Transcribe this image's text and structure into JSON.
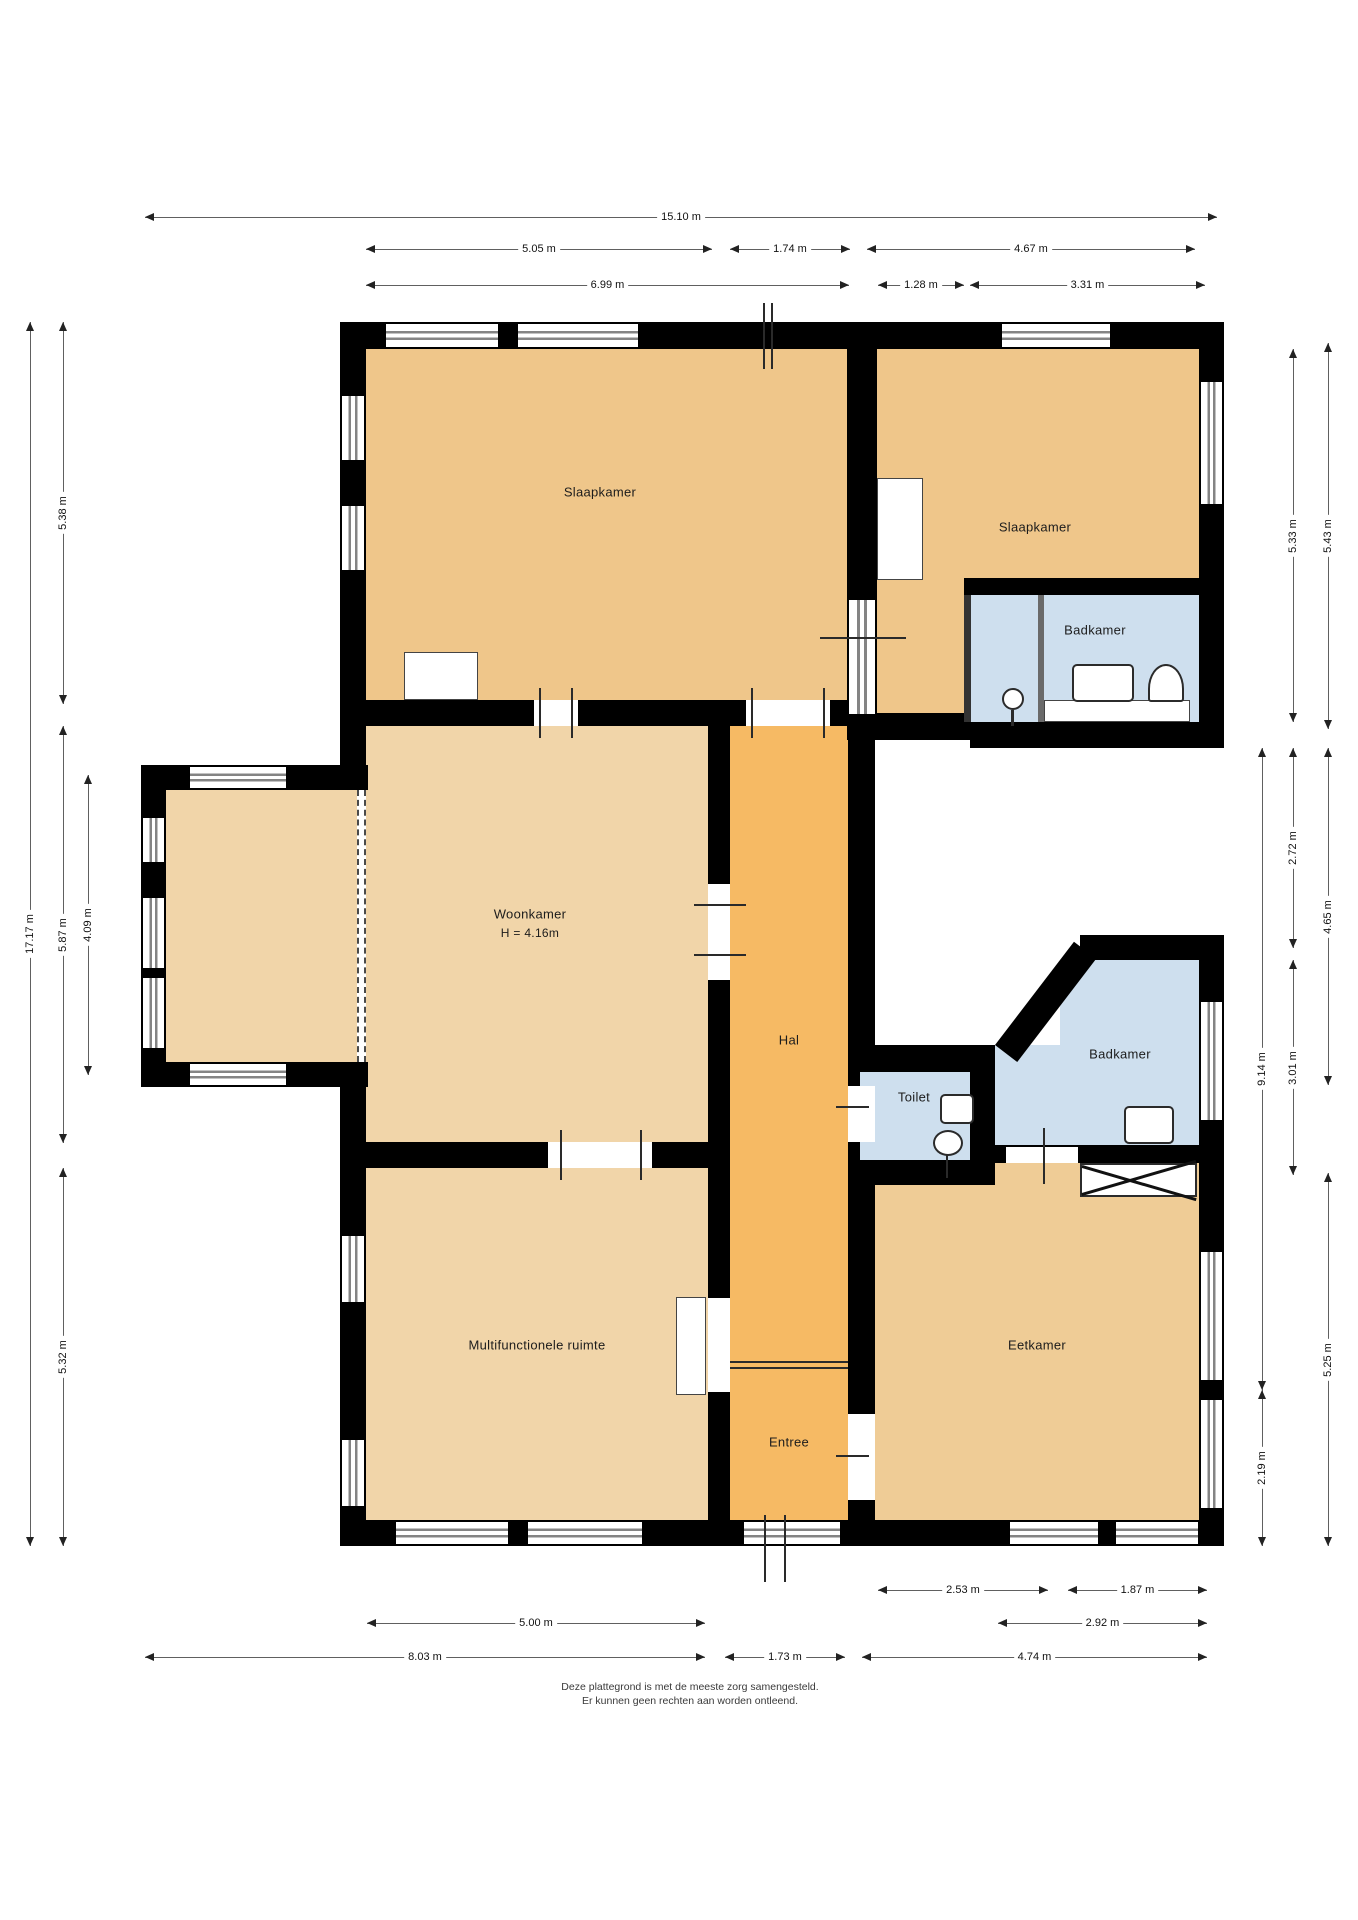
{
  "canvas": {
    "width": 1358,
    "height": 1920,
    "background": "#ffffff"
  },
  "colors": {
    "wall": "#000000",
    "bedroom_tan": "#efc68a",
    "dining_tan": "#efcc96",
    "living_tan": "#f1d5a9",
    "hall_orange": "#f6ba64",
    "bath_blue": "#cedfee",
    "dim_line": "#606060",
    "window_gray": "#848484"
  },
  "floors": [
    {
      "name": "room-slaapkamer-left",
      "x": 366,
      "y": 349,
      "w": 481,
      "h": 351,
      "c": "#efc68a"
    },
    {
      "name": "room-slaapkamer-right-main",
      "x": 877,
      "y": 349,
      "w": 322,
      "h": 229,
      "c": "#efc68a"
    },
    {
      "name": "room-slaapkamer-right-arm",
      "x": 877,
      "y": 578,
      "w": 87,
      "h": 135,
      "c": "#efc68a"
    },
    {
      "name": "room-badkamer-top",
      "x": 970,
      "y": 595,
      "w": 229,
      "h": 127,
      "c": "#cedfee"
    },
    {
      "name": "room-woonkamer",
      "x": 366,
      "y": 726,
      "w": 342,
      "h": 416,
      "c": "#f1d5a9"
    },
    {
      "name": "room-erker-bay",
      "x": 166,
      "y": 790,
      "w": 191,
      "h": 272,
      "c": "#f1d5a9"
    },
    {
      "name": "room-hal-entree",
      "x": 730,
      "y": 726,
      "w": 118,
      "h": 794,
      "c": "#f6ba64"
    },
    {
      "name": "room-toilet",
      "x": 860,
      "y": 1072,
      "w": 110,
      "h": 88,
      "c": "#cedfee"
    },
    {
      "name": "room-badkamer-mid-upper",
      "x": 1060,
      "y": 960,
      "w": 139,
      "h": 85,
      "c": "#cedfee"
    },
    {
      "name": "room-badkamer-mid-lower",
      "x": 995,
      "y": 1045,
      "w": 204,
      "h": 100,
      "c": "#cedfee"
    },
    {
      "name": "room-multifunctionele",
      "x": 366,
      "y": 1168,
      "w": 342,
      "h": 352,
      "c": "#f1d5a9"
    },
    {
      "name": "room-eetkamer",
      "x": 875,
      "y": 1160,
      "w": 324,
      "h": 360,
      "c": "#efcc96"
    }
  ],
  "walls": [
    [
      340,
      322,
      884,
      27
    ],
    [
      340,
      322,
      26,
      443
    ],
    [
      340,
      1087,
      26,
      459
    ],
    [
      340,
      1520,
      884,
      26
    ],
    [
      1199,
      322,
      25,
      426
    ],
    [
      1199,
      935,
      25,
      611
    ],
    [
      340,
      700,
      537,
      26
    ],
    [
      847,
      322,
      30,
      390
    ],
    [
      847,
      713,
      123,
      27
    ],
    [
      970,
      722,
      254,
      26
    ],
    [
      964,
      578,
      235,
      17
    ],
    [
      708,
      726,
      22,
      794
    ],
    [
      848,
      740,
      27,
      332
    ],
    [
      848,
      1072,
      12,
      88
    ],
    [
      848,
      1160,
      27,
      360
    ],
    [
      848,
      1045,
      147,
      27
    ],
    [
      970,
      1045,
      25,
      140
    ],
    [
      848,
      1160,
      147,
      25
    ],
    [
      1080,
      935,
      119,
      25
    ],
    [
      995,
      1145,
      204,
      18
    ],
    [
      340,
      1142,
      390,
      26
    ],
    [
      141,
      765,
      227,
      25
    ],
    [
      141,
      765,
      25,
      322
    ],
    [
      141,
      1062,
      227,
      25
    ]
  ],
  "diag_wall": {
    "x": 995,
    "y": 1045,
    "len": 130,
    "angle": -52.6,
    "th": 28
  },
  "thin_walls": [
    {
      "x": 964,
      "y": 595,
      "w": 7,
      "h": 127,
      "c": "#333333"
    },
    {
      "x": 1038,
      "y": 595,
      "w": 6,
      "h": 127,
      "c": "#6a6a6a"
    }
  ],
  "windows_h": [
    [
      384,
      324,
      112,
      23
    ],
    [
      516,
      324,
      120,
      23
    ],
    [
      1000,
      324,
      108,
      23
    ],
    [
      394,
      1522,
      112,
      22
    ],
    [
      526,
      1522,
      114,
      22
    ],
    [
      742,
      1522,
      96,
      22
    ],
    [
      1008,
      1522,
      88,
      22
    ],
    [
      1114,
      1522,
      82,
      22
    ],
    [
      188,
      767,
      96,
      21
    ],
    [
      188,
      1064,
      96,
      21
    ]
  ],
  "windows_v": [
    [
      342,
      394,
      22,
      64
    ],
    [
      342,
      504,
      22,
      64
    ],
    [
      342,
      1234,
      22,
      66
    ],
    [
      342,
      1438,
      22,
      66
    ],
    [
      1201,
      380,
      21,
      122
    ],
    [
      1201,
      1000,
      21,
      118
    ],
    [
      1201,
      1250,
      21,
      128
    ],
    [
      1201,
      1398,
      21,
      108
    ],
    [
      143,
      816,
      21,
      44
    ],
    [
      143,
      896,
      21,
      70
    ],
    [
      143,
      976,
      21,
      70
    ],
    [
      849,
      598,
      26,
      114
    ]
  ],
  "door_gaps": [
    [
      534,
      700,
      44,
      26
    ],
    [
      746,
      700,
      84,
      26
    ],
    [
      708,
      884,
      22,
      96
    ],
    [
      848,
      1086,
      27,
      56
    ],
    [
      1006,
      1147,
      72,
      16
    ],
    [
      848,
      1414,
      27,
      86
    ],
    [
      708,
      1298,
      22,
      94
    ],
    [
      548,
      1142,
      104,
      26
    ]
  ],
  "ticks": [
    [
      539,
      688,
      2,
      50
    ],
    [
      571,
      688,
      2,
      50
    ],
    [
      751,
      688,
      2,
      50
    ],
    [
      823,
      688,
      2,
      50
    ],
    [
      820,
      637,
      86,
      2
    ],
    [
      694,
      904,
      52,
      2
    ],
    [
      694,
      954,
      52,
      2
    ],
    [
      836,
      1106,
      33,
      2
    ],
    [
      1043,
      1128,
      2,
      56
    ],
    [
      836,
      1455,
      33,
      2
    ],
    [
      560,
      1130,
      2,
      50
    ],
    [
      640,
      1130,
      2,
      50
    ],
    [
      763,
      303,
      2,
      66
    ],
    [
      771,
      303,
      2,
      66
    ],
    [
      764,
      1515,
      2,
      67
    ],
    [
      784,
      1515,
      2,
      67
    ],
    [
      730,
      1361,
      118,
      2
    ],
    [
      730,
      1367,
      118,
      2
    ],
    [
      946,
      1154,
      2,
      24
    ],
    [
      1011,
      710,
      3,
      16
    ]
  ],
  "dashes": [
    [
      357,
      790,
      272
    ],
    [
      364,
      790,
      272
    ]
  ],
  "fixtures": [
    {
      "kind": "box",
      "name": "closet",
      "x": 404,
      "y": 652,
      "w": 74,
      "h": 48
    },
    {
      "kind": "box",
      "name": "door-leaf",
      "x": 877,
      "y": 478,
      "w": 46,
      "h": 102
    },
    {
      "kind": "box",
      "name": "door-leaf",
      "x": 676,
      "y": 1297,
      "w": 30,
      "h": 98
    },
    {
      "kind": "box",
      "name": "bath-counter",
      "x": 1044,
      "y": 700,
      "w": 146,
      "h": 22
    },
    {
      "kind": "rbox",
      "name": "washbasin",
      "x": 1072,
      "y": 664,
      "w": 62,
      "h": 38
    },
    {
      "kind": "arch",
      "name": "shower-sink",
      "x": 1148,
      "y": 664,
      "w": 36,
      "h": 38
    },
    {
      "kind": "circle",
      "name": "toilet-bowl",
      "x": 1002,
      "y": 688,
      "w": 22,
      "h": 22
    },
    {
      "kind": "rbox",
      "name": "hand-basin",
      "x": 940,
      "y": 1094,
      "w": 34,
      "h": 30
    },
    {
      "kind": "ellipse",
      "name": "toilet-bowl",
      "x": 933,
      "y": 1130,
      "w": 30,
      "h": 26
    },
    {
      "kind": "rbox",
      "name": "washbasin",
      "x": 1124,
      "y": 1106,
      "w": 50,
      "h": 38
    },
    {
      "kind": "xbox",
      "name": "cabinet-crossed",
      "x": 1080,
      "y": 1163,
      "w": 117,
      "h": 34
    }
  ],
  "labels": [
    {
      "text": "Slaapkamer",
      "x": 600,
      "y": 492,
      "fs": 13
    },
    {
      "text": "Slaapkamer",
      "x": 1035,
      "y": 527,
      "fs": 13
    },
    {
      "text": "Badkamer",
      "x": 1095,
      "y": 630,
      "fs": 13
    },
    {
      "text": "Woonkamer",
      "x": 530,
      "y": 914,
      "fs": 13
    },
    {
      "text": "H = 4.16m",
      "x": 530,
      "y": 933,
      "fs": 12
    },
    {
      "text": "Hal",
      "x": 789,
      "y": 1040,
      "fs": 13
    },
    {
      "text": "Toilet",
      "x": 914,
      "y": 1097,
      "fs": 13
    },
    {
      "text": "Badkamer",
      "x": 1120,
      "y": 1054,
      "fs": 13
    },
    {
      "text": "Multifunctionele ruimte",
      "x": 537,
      "y": 1345,
      "fs": 13
    },
    {
      "text": "Eetkamer",
      "x": 1037,
      "y": 1345,
      "fs": 13
    },
    {
      "text": "Entree",
      "x": 789,
      "y": 1442,
      "fs": 13
    }
  ],
  "dims_h": [
    {
      "label": "15.10 m",
      "x1": 145,
      "x2": 1217,
      "y": 217
    },
    {
      "label": "5.05 m",
      "x1": 366,
      "x2": 712,
      "y": 249
    },
    {
      "label": "1.74 m",
      "x1": 730,
      "x2": 850,
      "y": 249
    },
    {
      "label": "4.67 m",
      "x1": 867,
      "x2": 1195,
      "y": 249
    },
    {
      "label": "6.99 m",
      "x1": 366,
      "x2": 849,
      "y": 285
    },
    {
      "label": "1.28 m",
      "x1": 878,
      "x2": 964,
      "y": 285
    },
    {
      "label": "3.31 m",
      "x1": 970,
      "x2": 1205,
      "y": 285
    },
    {
      "label": "2.53 m",
      "x1": 878,
      "x2": 1048,
      "y": 1590
    },
    {
      "label": "1.87 m",
      "x1": 1068,
      "x2": 1207,
      "y": 1590
    },
    {
      "label": "5.00 m",
      "x1": 367,
      "x2": 705,
      "y": 1623
    },
    {
      "label": "2.92 m",
      "x1": 998,
      "x2": 1207,
      "y": 1623
    },
    {
      "label": "8.03 m",
      "x1": 145,
      "x2": 705,
      "y": 1657
    },
    {
      "label": "1.73 m",
      "x1": 725,
      "x2": 845,
      "y": 1657
    },
    {
      "label": "4.74 m",
      "x1": 862,
      "x2": 1207,
      "y": 1657
    }
  ],
  "dims_v": [
    {
      "label": "17.17 m",
      "x": 30,
      "y1": 322,
      "y2": 1546
    },
    {
      "label": "5.38 m",
      "x": 63,
      "y1": 322,
      "y2": 704
    },
    {
      "label": "5.87 m",
      "x": 63,
      "y1": 726,
      "y2": 1143
    },
    {
      "label": "5.32 m",
      "x": 63,
      "y1": 1168,
      "y2": 1546
    },
    {
      "label": "4.09 m",
      "x": 88,
      "y1": 775,
      "y2": 1075
    },
    {
      "label": "9.14 m",
      "x": 1262,
      "y1": 748,
      "y2": 1390
    },
    {
      "label": "2.19 m",
      "x": 1262,
      "y1": 1390,
      "y2": 1546
    },
    {
      "label": "5.33 m",
      "x": 1293,
      "y1": 349,
      "y2": 722
    },
    {
      "label": "2.72 m",
      "x": 1293,
      "y1": 748,
      "y2": 948
    },
    {
      "label": "3.01 m",
      "x": 1293,
      "y1": 960,
      "y2": 1175
    },
    {
      "label": "5.43 m",
      "x": 1328,
      "y1": 343,
      "y2": 729
    },
    {
      "label": "4.65 m",
      "x": 1328,
      "y1": 748,
      "y2": 1085
    },
    {
      "label": "5.25 m",
      "x": 1328,
      "y1": 1173,
      "y2": 1546
    }
  ],
  "footer": {
    "line1": "Deze plattegrond is met de meeste zorg samengesteld.",
    "line2": "Er kunnen geen rechten aan worden ontleend."
  }
}
